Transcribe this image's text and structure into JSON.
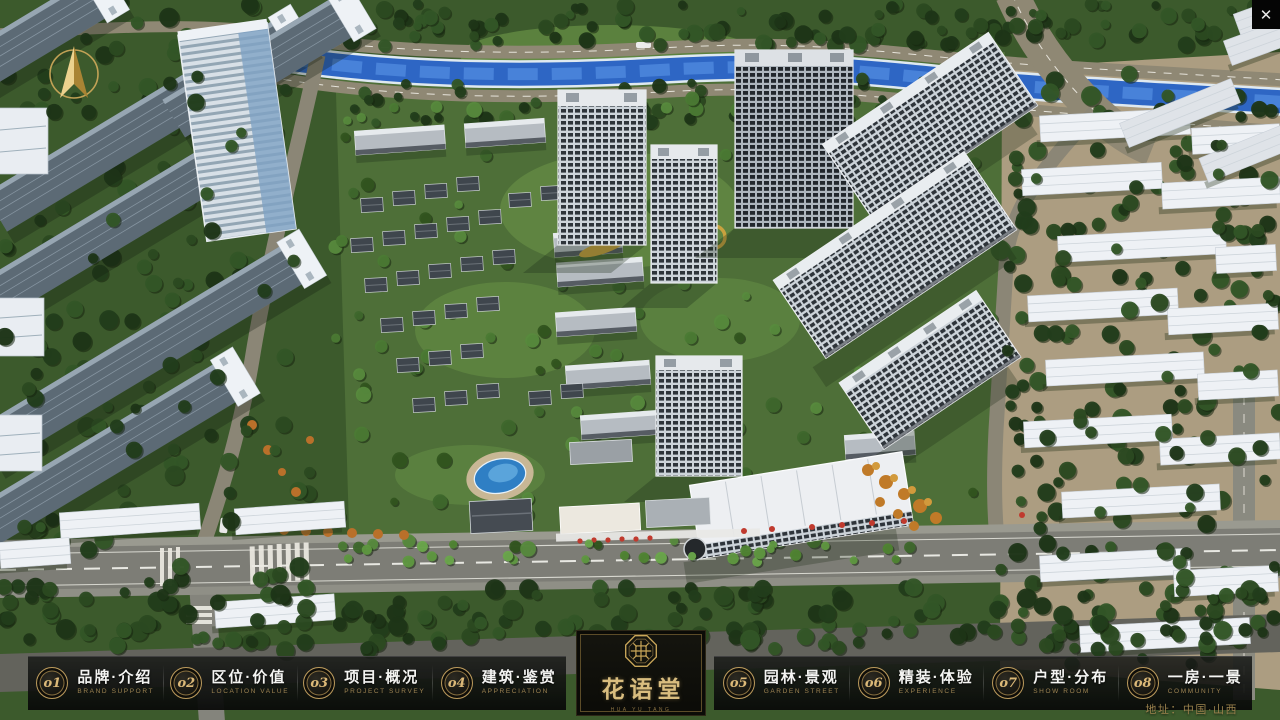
{
  "window": {
    "close_glyph": "✕"
  },
  "nav": {
    "items": [
      {
        "num": "o1",
        "zh": "品牌·介绍",
        "en": "BRAND SUPPORT"
      },
      {
        "num": "o2",
        "zh": "区位·价值",
        "en": "LOCATION VALUE"
      },
      {
        "num": "o3",
        "zh": "项目·概况",
        "en": "PROJECT SURVEY"
      },
      {
        "num": "o4",
        "zh": "建筑·鉴赏",
        "en": "APPRECIATION"
      },
      {
        "num": "o5",
        "zh": "园林·景观",
        "en": "GARDEN STREET"
      },
      {
        "num": "o6",
        "zh": "精装·体验",
        "en": "EXPERIENCE"
      },
      {
        "num": "o7",
        "zh": "户型·分布",
        "en": "SHOW ROOM"
      },
      {
        "num": "o8",
        "zh": "一房·一景",
        "en": "COMMUNITY"
      }
    ]
  },
  "logo": {
    "name": "花语堂",
    "tagline": "HUA YU TANG"
  },
  "footer": {
    "address": "地址：中国·山西"
  },
  "colors": {
    "gold": "#c9a659",
    "navbar_bg": "#121310",
    "river": "#2e66c4",
    "lawn": "#4e6f38"
  }
}
